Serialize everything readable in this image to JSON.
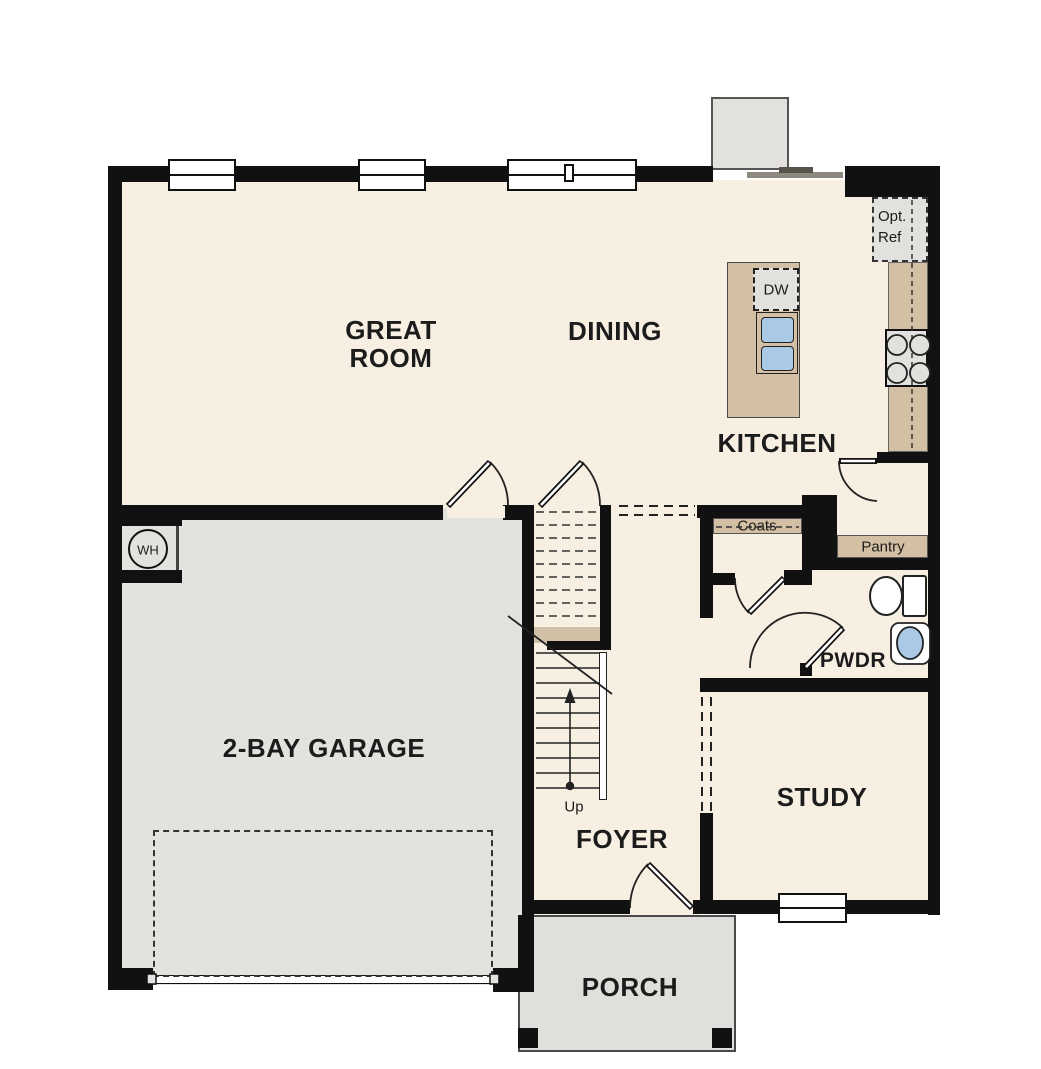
{
  "floorplan": {
    "rooms": {
      "great_room": {
        "label_line1": "GREAT",
        "label_line2": "ROOM"
      },
      "dining": {
        "label": "DINING"
      },
      "kitchen": {
        "label": "KITCHEN"
      },
      "garage": {
        "label": "2-BAY GARAGE"
      },
      "foyer": {
        "label": "FOYER"
      },
      "study": {
        "label": "STUDY"
      },
      "porch": {
        "label": "PORCH"
      },
      "powder_room": {
        "label": "PWDR"
      }
    },
    "annotations": {
      "coats_closet": "Coats",
      "pantry": "Pantry",
      "optional_refrigerator_line1": "Opt.",
      "optional_refrigerator_line2": "Ref",
      "dishwasher": "DW",
      "water_heater": "WH",
      "stairs_direction": "Up"
    },
    "colors": {
      "wall": "#111111",
      "floor": "#f6efe2",
      "garage_floor": "#e4e2df",
      "porch_floor": "#e1dfdc",
      "cabinet_tan": "#d3c0a4",
      "appliance_gray": "#e3e1de",
      "sink_blue": "#a9c9e5"
    }
  }
}
